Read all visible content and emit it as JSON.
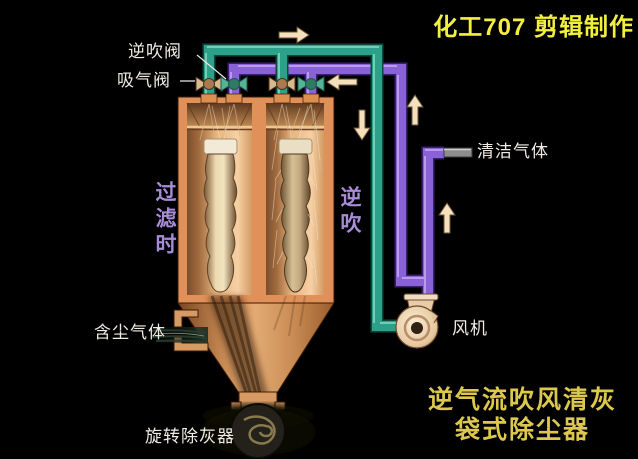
{
  "watermark": "化工707 剪辑制作",
  "caption": {
    "line1": "逆气流吹风清灰",
    "line2": "袋式除尘器"
  },
  "labels": {
    "reverse_blow_valve": "逆吹阀",
    "suction_valve": "吸气阀",
    "filtering_side": "过滤时",
    "reverse_blow_side": "逆吹",
    "clean_gas": "清洁气体",
    "fan": "风机",
    "dusty_gas": "含尘气体",
    "rotary_ash_remover": "旋转除灰器"
  },
  "flow_arrows": [
    {
      "icon": "arrow-right-icon",
      "location": "above suction manifold"
    },
    {
      "icon": "arrow-left-icon",
      "location": "reverse-blow manifold toward valve"
    },
    {
      "icon": "arrow-up-icon",
      "location": "reverse-blow riser"
    },
    {
      "icon": "arrow-down-icon",
      "location": "suction downcomer to fan"
    },
    {
      "icon": "arrow-up-icon",
      "location": "clean-gas riser to outlet"
    }
  ],
  "colors": {
    "background": "#000000",
    "suction_pipe_teal": "#2f9f86",
    "clean_gas_pipe_purple": "#8a61d6",
    "vessel_wall_orange": "#e0915a",
    "vessel_interior_peach": "#f2c99e",
    "arrow_cream": "#f4e0bc",
    "watermark_yellow": "#f2ef3e",
    "caption_yellow": "#dcc84e",
    "side_label_purple": "#a88cd8",
    "label_white": "#f0ece4"
  }
}
